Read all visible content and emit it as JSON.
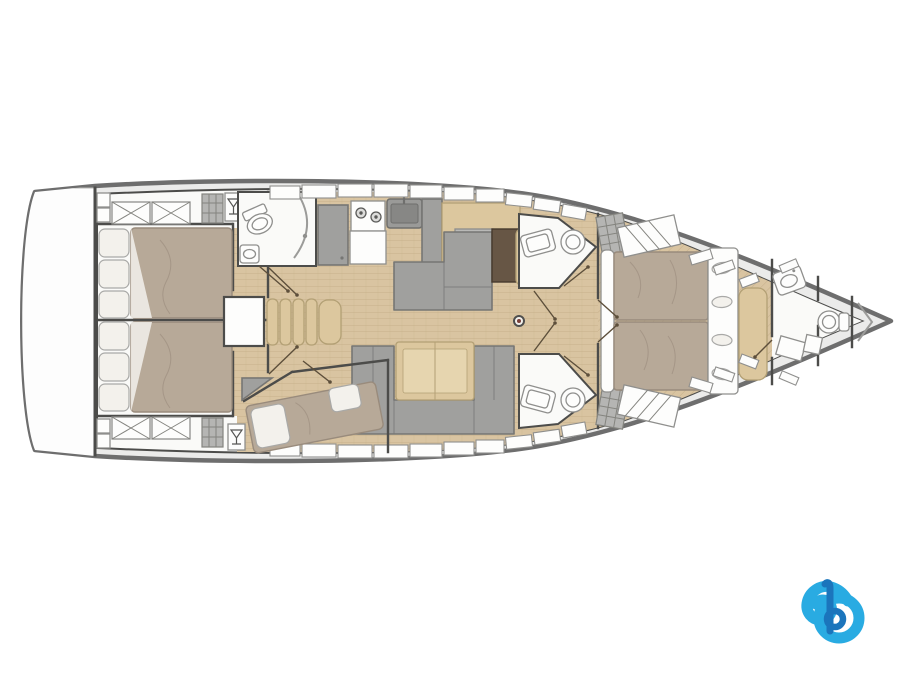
{
  "canvas": {
    "width": 903,
    "height": 675,
    "background": "#ffffff"
  },
  "plan": {
    "title": "Sailing yacht interior layout floor plan, top view, bow to the right",
    "type": "yacht-deck-plan",
    "orientation": "bow-right",
    "rooms": [
      {
        "name": "swim-platform",
        "fixtures": []
      },
      {
        "name": "aft-cabin-port",
        "fixtures": [
          "double-bed",
          "pillows",
          "deck-lockers-x"
        ]
      },
      {
        "name": "aft-cabin-starboard",
        "fixtures": [
          "double-bed",
          "pillows",
          "deck-lockers-x"
        ]
      },
      {
        "name": "companionway",
        "fixtures": [
          "stairs",
          "engine-compartment"
        ]
      },
      {
        "name": "aft-head-port",
        "fixtures": [
          "toilet",
          "shower-screen",
          "washbasin"
        ]
      },
      {
        "name": "galley",
        "fixtures": [
          "stove-two-burners",
          "sink",
          "cabinets",
          "refrigerator",
          "counter"
        ]
      },
      {
        "name": "salon",
        "fixtures": [
          "l-sofa",
          "chart-table",
          "nav-seat",
          "dining-table",
          "u-sofa",
          "mast-post"
        ]
      },
      {
        "name": "bunk-cabin-starboard",
        "fixtures": [
          "angled-double-berth",
          "pillows",
          "corner-wardrobe"
        ]
      },
      {
        "name": "mid-head-port",
        "fixtures": [
          "washbasin",
          "toilet"
        ]
      },
      {
        "name": "mid-head-starboard",
        "fixtures": [
          "washbasin",
          "toilet"
        ]
      },
      {
        "name": "owner-cabin",
        "fixtures": [
          "island-double-bed",
          "headboard",
          "side-cushions",
          "wardrobes",
          "deck-hatches"
        ]
      },
      {
        "name": "forward-head",
        "fixtures": [
          "washbasin",
          "toilet",
          "lockers"
        ]
      },
      {
        "name": "anchor-locker",
        "fixtures": [
          "chain-chevron"
        ]
      }
    ]
  },
  "logo": {
    "name": "stylized-letter-b-logo",
    "position": "bottom-right"
  },
  "colors": {
    "bg": "#ffffff",
    "hull_stroke": "#6e6e6e",
    "deck": "#ebebea",
    "room_white": "#fafaf8",
    "wall": "#4c4c4a",
    "wood": "#d9c4a1",
    "wood_line": "#c5ae87",
    "furn_gray": "#a0a09e",
    "furn_gray_dark": "#767674",
    "tan": "#dcc79e",
    "tan_dark": "#b3a075",
    "nav_table": "#675645",
    "mattress": "#b7a998",
    "mattress_dark": "#998b7c",
    "pillow": "#f3f1ec",
    "pillow_stroke": "#a9a9a7",
    "fixture_white": "#fdfdfc",
    "fixture_stroke": "#8f8f8d",
    "hatch": "#b5b5b3",
    "hatch_line": "#84847f",
    "door_line": "#5d4f3b",
    "logo_light": "#29abe2",
    "logo_dark": "#1b75bc",
    "mast_dot": "#7a3f38"
  }
}
